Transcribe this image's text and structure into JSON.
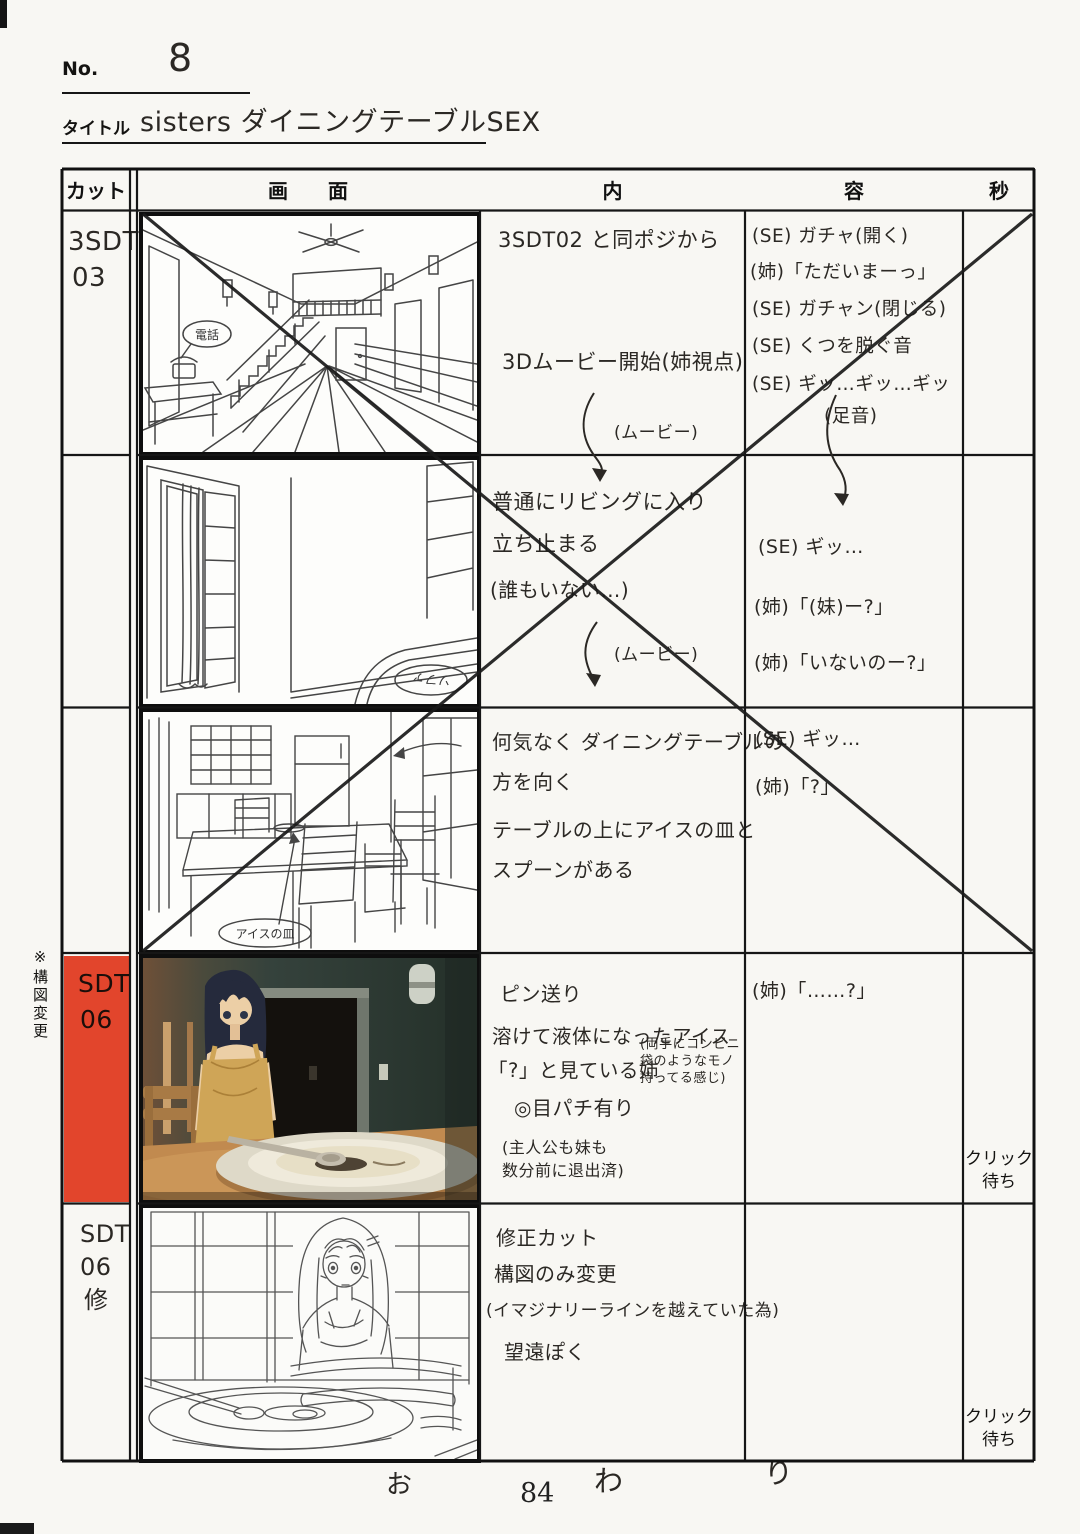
{
  "page": {
    "no_label": "No.",
    "no_value": "8",
    "title_label": "タイトル",
    "title_value": "sisters ダイニングテーブルSEX",
    "page_number": "84",
    "footer_marks": [
      "お",
      "わ",
      "り"
    ],
    "margin_note": "※構図変更"
  },
  "colors": {
    "highlight_red": "#e2452c"
  },
  "table": {
    "headers": {
      "cut": "カット",
      "screen": "画　　面",
      "content": "内",
      "dialog": "容",
      "seconds": "秒"
    }
  },
  "rows": [
    {
      "cut_lines": [
        "3SDT",
        "03"
      ],
      "panel_label": "電話",
      "content_lines": [
        "3SDT02 と同ポジから",
        "3Dムービー開始(姉視点)"
      ],
      "movie_label": "(ムービー)",
      "dialog_lines": [
        "(SE) ガチャ(開く)",
        "(姉)「ただいまーっ」",
        "(SE) ガチャン(閉じる)",
        "(SE) くつを脱ぐ音",
        "(SE) ギッ…ギッ…ギッ",
        "(足音)"
      ],
      "seconds": ""
    },
    {
      "cut_lines": [],
      "panel_label": "ソファ",
      "content_lines": [
        "普通にリビングに入り",
        "立ち止まる",
        "(誰もいない…)"
      ],
      "movie_label": "(ムービー)",
      "dialog_lines": [
        "(SE) ギッ…",
        "(姉)「(妹)ー?」",
        "(姉)「いないのー?」"
      ],
      "seconds": ""
    },
    {
      "cut_lines": [],
      "panel_label": "アイスの皿",
      "content_lines": [
        "何気なく ダイニングテーブルの",
        "方を向く",
        "テーブルの上にアイスの皿と",
        "スプーンがある"
      ],
      "dialog_lines": [
        "(SE) ギッ…",
        "(姉)「?」"
      ],
      "seconds": ""
    },
    {
      "cut_lines": [
        "SDT",
        "06"
      ],
      "highlighted": true,
      "content_lines": [
        "ピン送り",
        "溶けて液体になったアイス",
        "「?」と見ている姉",
        "◎目パチ有り"
      ],
      "side_note_lines": [
        "(両手にコンビニ",
        "袋のようなモノ",
        "持ってる感じ)"
      ],
      "bottom_note_lines": [
        "(主人公も妹も",
        "数分前に退出済)"
      ],
      "dialog_lines": [
        "(姉)「……?」"
      ],
      "seconds": "クリック待ち"
    },
    {
      "cut_lines": [
        "SDT",
        "06",
        "修"
      ],
      "content_lines": [
        "修正カット",
        "構図のみ変更",
        "(イマジナリーラインを越えていた為)",
        "望遠ぽく"
      ],
      "dialog_lines": [],
      "seconds": "クリック待ち"
    }
  ]
}
